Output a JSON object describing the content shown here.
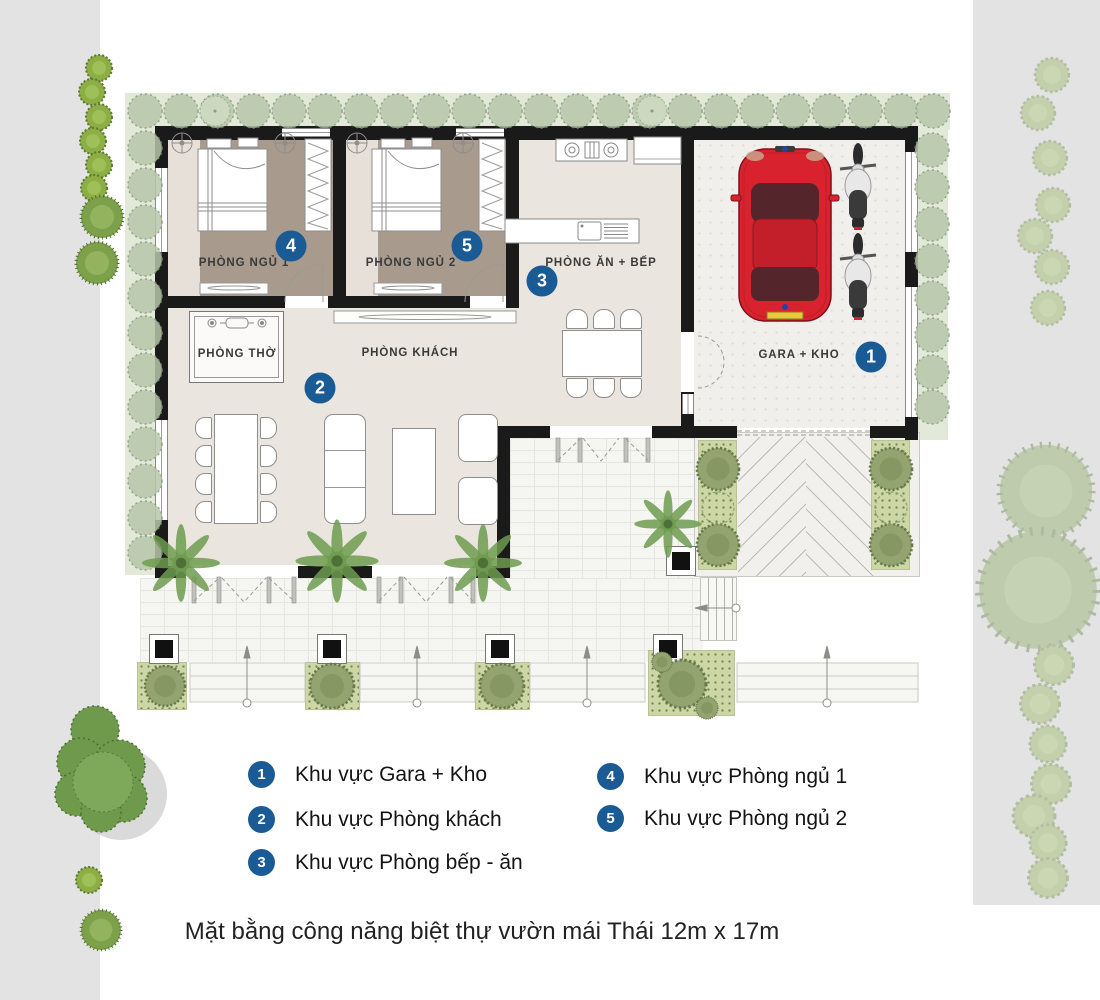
{
  "plan": {
    "bedroom1": {
      "label": "PHÒNG NGỦ 1",
      "marker": "4"
    },
    "bedroom2": {
      "label": "PHÒNG NGỦ 2",
      "marker": "5"
    },
    "kitchen": {
      "label": "PHÒNG ĂN + BẾP",
      "marker": "3"
    },
    "living": {
      "label": "PHÒNG KHÁCH",
      "marker": "2"
    },
    "worship": {
      "label": "PHÒNG THỜ"
    },
    "garage": {
      "label": "GARA + KHO",
      "marker": "1"
    }
  },
  "legend": {
    "column1": [
      {
        "num": "1",
        "label": "Khu vực Gara + Kho"
      },
      {
        "num": "2",
        "label": "Khu vực Phòng khách"
      },
      {
        "num": "3",
        "label": "Khu vực Phòng bếp - ăn"
      }
    ],
    "column2": [
      {
        "num": "4",
        "label": "Khu vực Phòng ngủ 1"
      },
      {
        "num": "5",
        "label": "Khu vực Phòng ngủ 2"
      }
    ]
  },
  "caption": "Mặt bằng công năng biệt thự vườn mái Thái 12m x 17m",
  "colors": {
    "marker_blue": "#1a5b95",
    "car_red": "#d8232f"
  }
}
